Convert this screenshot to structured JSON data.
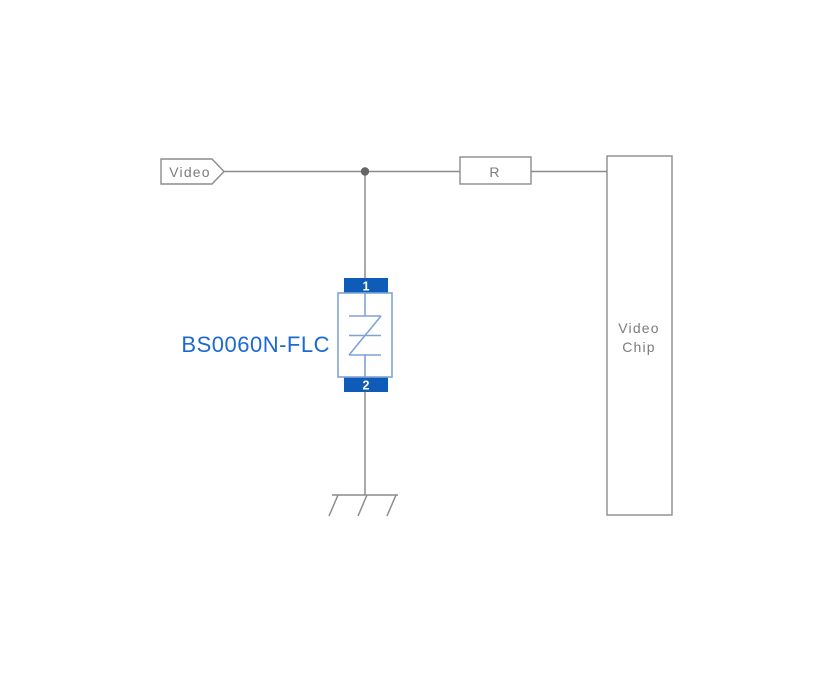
{
  "schematic": {
    "net_label": "Video",
    "resistor": {
      "label": "R"
    },
    "chip": {
      "name_line1": "Video",
      "name_line2": "Chip"
    },
    "tvs": {
      "part_number": "BS0060N-FLC",
      "pin_top": "1",
      "pin_bottom": "2"
    },
    "colors": {
      "background": "#ffffff",
      "wire": "#8c8c8c",
      "label_text": "#7c7c7c",
      "junction_dot": "#666666",
      "terminal_blue": "#0e5cb8",
      "symbol_blue": "#7fa3d6",
      "part_label_blue": "#1b6ad2"
    }
  }
}
